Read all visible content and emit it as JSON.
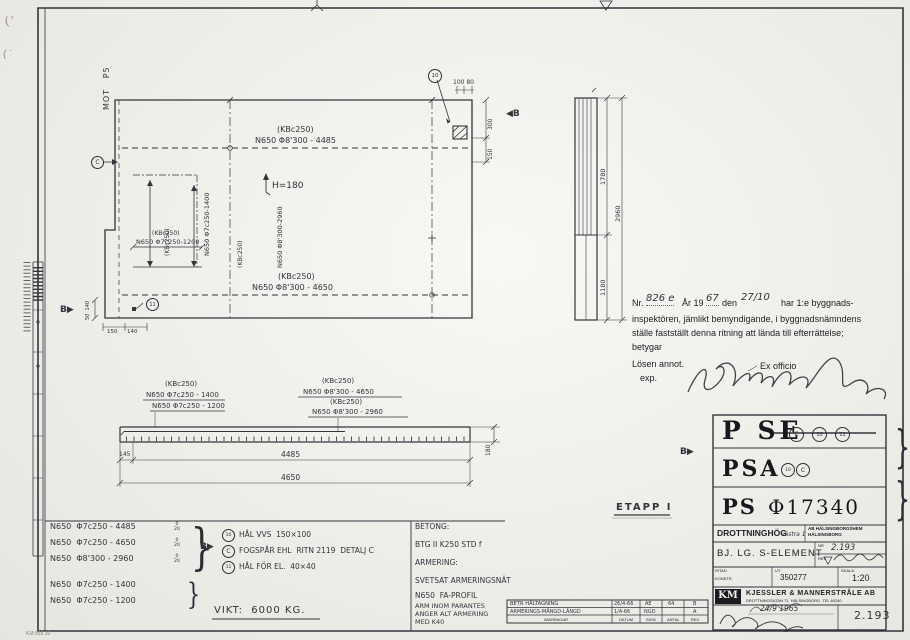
{
  "drawing": {
    "plan": {
      "mot_p5": "MOT   P5",
      "top_note_1": "(KBc250)",
      "top_note_2": "N650 Φ8'300 - 4485",
      "h_label": "H=180",
      "hole_dims_top": "100 80",
      "dim_300": "300",
      "dim_150": "150",
      "callout_10": "10",
      "marker_b_right": "◀B",
      "inner_vert1_1": "(KBc250)",
      "inner_vert1_2": "N650 Φ7c250-1400",
      "inner_vert2_1": "(KBc250)",
      "inner_vert2_2": "N650 Φ8'300-2960",
      "inner_h_1": "(KBc250)",
      "inner_h_2": "N650 Φ7c250-1200",
      "bottom_note_1": "(KBc250)",
      "bottom_note_2": "N650 Φ8'300 - 4650",
      "callout_11": "11",
      "callout_c": "C",
      "marker_b_left": "B▶",
      "dim_50_140": "50  140",
      "dim_150b": "150",
      "dim_140b": "140"
    },
    "section": {
      "dim_1780": "1780",
      "dim_1180": "1180",
      "dim_2960": "2960"
    },
    "elevation": {
      "l1": "(KBc250)",
      "l2": "N650 Φ7c250 - 1400",
      "l3": "N650 Φ7c250 - 1200",
      "r1": "(KBc250)",
      "r2": "N650 Φ8'300 - 4650",
      "r3": "(KBc250)",
      "r4": "N650 Φ8'300 - 2960",
      "dim_145": "145",
      "dim_4485": "4485",
      "dim_4650": "4650",
      "dim_180": "180"
    },
    "etapp_label": "ETAPP I"
  },
  "stamp": {
    "nr_label": "Nr.",
    "nr_value": "826 e",
    "ar_label": "År 19",
    "ar_value": "67",
    "den_label": "den",
    "den_value": "27/10",
    "line1_rest": "har 1:e byggnads-",
    "line2": "inspektören, jämlikt bemyndigande, i byggnadsnämndens",
    "line3": "ställe fastställt denna ritning att lända till efterrättelse;",
    "line4": "betygar",
    "losen": "Lösen annot.",
    "exp": "exp.",
    "ex_officio": "Ex officio"
  },
  "rebar_list": {
    "rows": [
      {
        "spec": "N650  Φ7c250 - 4485",
        "tol_top": "0",
        "tol_bottom": "20"
      },
      {
        "spec": "N650  Φ7c250 - 4650",
        "tol_top": "0",
        "tol_bottom": "20"
      },
      {
        "spec": "N650  Φ8'300 - 2960",
        "tol_top": "0",
        "tol_bottom": "20"
      },
      {
        "spec": "N650  Φ7c250 - 1400"
      },
      {
        "spec": "N650  Φ7c250 - 1200"
      }
    ],
    "marker_b": "B▶"
  },
  "notes": {
    "items": [
      {
        "sym": "10",
        "text": "HÅL VVS  150×100"
      },
      {
        "sym": "C",
        "text": "FOGSPÅR EHL  RITN 2119  DETALJ C"
      },
      {
        "sym": "11",
        "text": "HÅL FÖR EL.  40×40"
      }
    ],
    "weight": "VIKT:  6000 KG."
  },
  "materials": {
    "betong_label": "BETONG:",
    "betong": "BTG II K250 STD f",
    "armering_label": "ARMERING:",
    "armering": "SVETSAT ARMERINGSNÄT",
    "profil": "N650  FA-PROFIL",
    "paren1": "ARM INOM PARANTES",
    "paren2": "ANGER ALT ARMERING",
    "paren3": "MED K40"
  },
  "revisions": {
    "rows": [
      {
        "text": "BETR HÅLTAGNING",
        "datum": "26/4-66",
        "sign": "ÄE",
        "antal": "64",
        "rev": "B"
      },
      {
        "text": "ARMERINGS-MÄNGD-LÄNGD",
        "datum": "1/4-66",
        "sign": "NGD",
        "antal": "",
        "rev": "A"
      }
    ],
    "headers": {
      "text": "ÄNDRINGAR",
      "datum": "DATUM",
      "sign": "SIGN",
      "antal": "ANTAL",
      "rev": "REV."
    }
  },
  "title_block": {
    "row1_code": "P SE",
    "row1_marks": [
      "C",
      "10",
      "11"
    ],
    "row2_code": "PSA",
    "row2_marks": [
      "10",
      "C"
    ],
    "row3_code": "PS",
    "row3_number": "Φ17340",
    "project": "DROTTNINGHÖG",
    "project_part": "västra 1",
    "client_1": "AB HÄLSINGBORGSHEM",
    "client_2": "HÄLSINGBORG",
    "element": "BJ. LG. S-ELEMENT",
    "nr_label": "NR",
    "nr_value": "2.193",
    "rev_label": "REV.",
    "ritad_label": "RITAD",
    "konstr_label": "KONSTR.",
    "ut_label": "UT",
    "ut_value": "350277",
    "skala_label": "SKALA",
    "skala_value": "1:20",
    "logo": "KM",
    "company": "KJESSLER & MANNERSTRÅLE AB",
    "company_address": "DROTTNINGGATAN 71  HÄLSINGBORG  TEL 60240",
    "date_value": "24/9 1965",
    "sheet_no": "2.193",
    "marker_b": "B▶"
  },
  "margins": {
    "corner_note": "KM 858.39",
    "brace": "}"
  }
}
